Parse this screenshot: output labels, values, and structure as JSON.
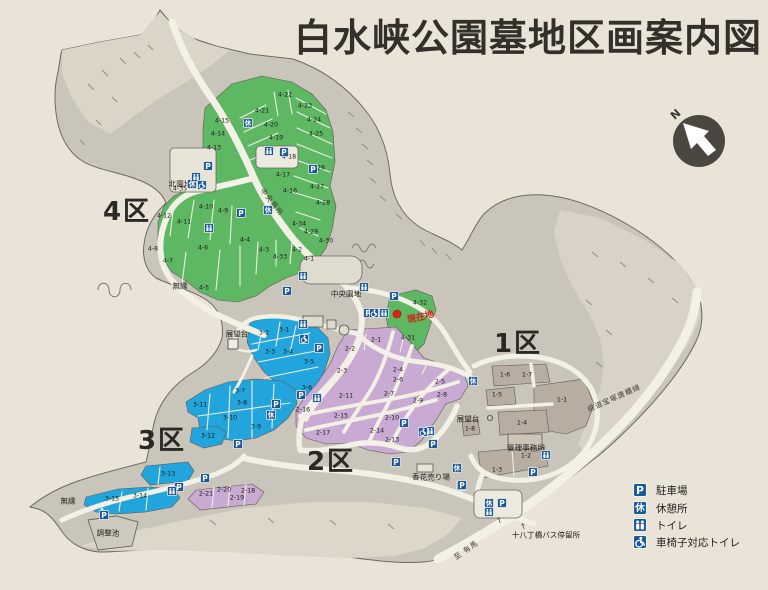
{
  "title": "白水峡公園墓地区画案内図",
  "compass": {
    "label": "N"
  },
  "current_location": {
    "label": "現在地",
    "color": "#d22017"
  },
  "colors": {
    "paper": "#e9e4d7",
    "land": "#cac5ba",
    "light_terrain": "#d9d4c7",
    "road": "#f3f0e5",
    "zone1": "#b7aea1",
    "zone2": "#c8aad3",
    "zone3": "#22a5dc",
    "zone4": "#5eb763",
    "icon_blue": "#1c599c",
    "red": "#e02318"
  },
  "legend": {
    "items": [
      {
        "type": "parking",
        "label": "駐車場"
      },
      {
        "type": "rest",
        "label": "休憩所"
      },
      {
        "type": "toilet",
        "label": "トイレ"
      },
      {
        "type": "wheelchair",
        "label": "車椅子対応トイレ"
      }
    ]
  },
  "zones": [
    {
      "name": "4区",
      "color": "#5eb763",
      "label_x": 127,
      "label_y": 212,
      "plots": [
        {
          "label": "4-1",
          "x": 309,
          "y": 259
        },
        {
          "label": "4-2",
          "x": 297,
          "y": 250
        },
        {
          "label": "4-3",
          "x": 264,
          "y": 250
        },
        {
          "label": "4-4",
          "x": 245,
          "y": 240
        },
        {
          "label": "4-5",
          "x": 204,
          "y": 288
        },
        {
          "label": "4-6",
          "x": 203,
          "y": 248
        },
        {
          "label": "4-7",
          "x": 168,
          "y": 261
        },
        {
          "label": "4-8",
          "x": 153,
          "y": 249
        },
        {
          "label": "4-9",
          "x": 223,
          "y": 211
        },
        {
          "label": "4-10",
          "x": 206,
          "y": 207
        },
        {
          "label": "4-11",
          "x": 184,
          "y": 222
        },
        {
          "label": "4-12",
          "x": 164,
          "y": 216
        },
        {
          "label": "4-13",
          "x": 214,
          "y": 148
        },
        {
          "label": "4-14",
          "x": 218,
          "y": 134
        },
        {
          "label": "4-15",
          "x": 222,
          "y": 121
        },
        {
          "label": "4-16",
          "x": 290,
          "y": 191
        },
        {
          "label": "4-17",
          "x": 283,
          "y": 175
        },
        {
          "label": "4-18",
          "x": 289,
          "y": 157
        },
        {
          "label": "4-19",
          "x": 276,
          "y": 138
        },
        {
          "label": "4-20",
          "x": 271,
          "y": 125
        },
        {
          "label": "4-21",
          "x": 262,
          "y": 111
        },
        {
          "label": "4-22",
          "x": 285,
          "y": 95
        },
        {
          "label": "4-23",
          "x": 305,
          "y": 106
        },
        {
          "label": "4-24",
          "x": 314,
          "y": 120
        },
        {
          "label": "4-25",
          "x": 316,
          "y": 134
        },
        {
          "label": "4-26",
          "x": 318,
          "y": 168
        },
        {
          "label": "4-27",
          "x": 317,
          "y": 187
        },
        {
          "label": "4-28",
          "x": 323,
          "y": 203
        },
        {
          "label": "4-29",
          "x": 311,
          "y": 232
        },
        {
          "label": "4-30",
          "x": 326,
          "y": 241
        },
        {
          "label": "4-31",
          "x": 408,
          "y": 338
        },
        {
          "label": "4-32",
          "x": 420,
          "y": 303
        },
        {
          "label": "4-33",
          "x": 280,
          "y": 257
        },
        {
          "label": "4-34",
          "x": 299,
          "y": 224
        },
        {
          "label": "4-35",
          "x": 180,
          "y": 189
        }
      ]
    },
    {
      "name": "3区",
      "color": "#22a5dc",
      "label_x": 162,
      "label_y": 441,
      "plots": [
        {
          "label": "3-1",
          "x": 284,
          "y": 330
        },
        {
          "label": "3-2",
          "x": 264,
          "y": 333
        },
        {
          "label": "3-3",
          "x": 270,
          "y": 352
        },
        {
          "label": "3-4",
          "x": 288,
          "y": 352
        },
        {
          "label": "3-5",
          "x": 309,
          "y": 362
        },
        {
          "label": "3-6",
          "x": 307,
          "y": 388
        },
        {
          "label": "3-7",
          "x": 240,
          "y": 391
        },
        {
          "label": "3-8",
          "x": 242,
          "y": 403
        },
        {
          "label": "3-9",
          "x": 256,
          "y": 427
        },
        {
          "label": "3-10",
          "x": 230,
          "y": 418
        },
        {
          "label": "3-11",
          "x": 200,
          "y": 405
        },
        {
          "label": "3-12",
          "x": 208,
          "y": 436
        },
        {
          "label": "3-13",
          "x": 168,
          "y": 474
        },
        {
          "label": "3-14",
          "x": 140,
          "y": 496
        },
        {
          "label": "3-15",
          "x": 112,
          "y": 499
        }
      ]
    },
    {
      "name": "2区",
      "color": "#c8aad3",
      "label_x": 331,
      "label_y": 462,
      "plots": [
        {
          "label": "2-1",
          "x": 376,
          "y": 340
        },
        {
          "label": "2-2",
          "x": 350,
          "y": 349
        },
        {
          "label": "2-3",
          "x": 342,
          "y": 371
        },
        {
          "label": "2-4",
          "x": 398,
          "y": 370
        },
        {
          "label": "2-5",
          "x": 440,
          "y": 382
        },
        {
          "label": "2-6",
          "x": 398,
          "y": 380
        },
        {
          "label": "2-7",
          "x": 389,
          "y": 394
        },
        {
          "label": "2-8",
          "x": 442,
          "y": 395
        },
        {
          "label": "2-9",
          "x": 418,
          "y": 401
        },
        {
          "label": "2-10",
          "x": 392,
          "y": 418
        },
        {
          "label": "2-11",
          "x": 346,
          "y": 396
        },
        {
          "label": "2-13",
          "x": 392,
          "y": 440
        },
        {
          "label": "2-14",
          "x": 377,
          "y": 431
        },
        {
          "label": "2-15",
          "x": 341,
          "y": 416
        },
        {
          "label": "2-16",
          "x": 303,
          "y": 410
        },
        {
          "label": "2-17",
          "x": 323,
          "y": 433
        },
        {
          "label": "2-18",
          "x": 248,
          "y": 491
        },
        {
          "label": "2-19",
          "x": 237,
          "y": 498
        },
        {
          "label": "2-20",
          "x": 224,
          "y": 490
        },
        {
          "label": "2-21",
          "x": 206,
          "y": 494
        }
      ]
    },
    {
      "name": "1区",
      "color": "#b7aea1",
      "label_x": 518,
      "label_y": 344,
      "plots": [
        {
          "label": "1-1",
          "x": 562,
          "y": 400
        },
        {
          "label": "1-2",
          "x": 526,
          "y": 456
        },
        {
          "label": "1-3",
          "x": 497,
          "y": 470
        },
        {
          "label": "1-4",
          "x": 522,
          "y": 423
        },
        {
          "label": "1-5",
          "x": 497,
          "y": 395
        },
        {
          "label": "1-6",
          "x": 505,
          "y": 375
        },
        {
          "label": "1-7",
          "x": 527,
          "y": 375
        },
        {
          "label": "1-8",
          "x": 470,
          "y": 429
        }
      ]
    }
  ],
  "places": [
    {
      "label": "北園地",
      "x": 180,
      "y": 184
    },
    {
      "label": "中央園地",
      "x": 346,
      "y": 294
    },
    {
      "label": "展望台",
      "x": 237,
      "y": 334
    },
    {
      "label": "展望台",
      "x": 468,
      "y": 419
    },
    {
      "label": "管理事務所",
      "x": 526,
      "y": 448
    },
    {
      "label": "香花売り場",
      "x": 431,
      "y": 477
    },
    {
      "label": "十八丁橋バス停留所",
      "x": 546,
      "y": 535
    },
    {
      "label": "無縁",
      "x": 180,
      "y": 286
    },
    {
      "label": "無縁",
      "x": 68,
      "y": 501
    },
    {
      "label": "調整池",
      "x": 108,
      "y": 533
    }
  ],
  "road_labels": [
    {
      "label": "中央墓所",
      "x": 272,
      "y": 202,
      "rot": 52
    },
    {
      "label": "県道宝塚唐櫃線",
      "x": 614,
      "y": 398,
      "rot": -24
    },
    {
      "label": "至 有馬",
      "x": 466,
      "y": 550,
      "rot": -35
    }
  ],
  "icons": [
    {
      "type": "parking",
      "x": 208,
      "y": 166
    },
    {
      "type": "parking",
      "x": 284,
      "y": 152
    },
    {
      "type": "parking",
      "x": 313,
      "y": 169
    },
    {
      "type": "parking",
      "x": 241,
      "y": 213
    },
    {
      "type": "parking",
      "x": 287,
      "y": 291
    },
    {
      "type": "parking",
      "x": 394,
      "y": 296
    },
    {
      "type": "parking",
      "x": 368,
      "y": 313
    },
    {
      "type": "parking",
      "x": 319,
      "y": 348
    },
    {
      "type": "parking",
      "x": 301,
      "y": 395
    },
    {
      "type": "parking",
      "x": 276,
      "y": 404
    },
    {
      "type": "parking",
      "x": 238,
      "y": 444
    },
    {
      "type": "parking",
      "x": 404,
      "y": 423
    },
    {
      "type": "parking",
      "x": 433,
      "y": 444
    },
    {
      "type": "parking",
      "x": 396,
      "y": 462
    },
    {
      "type": "parking",
      "x": 461,
      "y": 486
    },
    {
      "type": "parking",
      "x": 205,
      "y": 478
    },
    {
      "type": "parking",
      "x": 179,
      "y": 487
    },
    {
      "type": "parking",
      "x": 104,
      "y": 515
    },
    {
      "type": "parking",
      "x": 533,
      "y": 472
    },
    {
      "type": "parking",
      "x": 462,
      "y": 485
    },
    {
      "type": "parking",
      "x": 502,
      "y": 503
    },
    {
      "type": "rest",
      "x": 248,
      "y": 123
    },
    {
      "type": "rest",
      "x": 268,
      "y": 210
    },
    {
      "type": "rest",
      "x": 192,
      "y": 184
    },
    {
      "type": "rest",
      "x": 271,
      "y": 415
    },
    {
      "type": "rest",
      "x": 473,
      "y": 381
    },
    {
      "type": "rest",
      "x": 457,
      "y": 468
    },
    {
      "type": "rest",
      "x": 489,
      "y": 503
    },
    {
      "type": "toilet",
      "x": 269,
      "y": 151
    },
    {
      "type": "toilet",
      "x": 196,
      "y": 177
    },
    {
      "type": "toilet",
      "x": 209,
      "y": 228
    },
    {
      "type": "toilet",
      "x": 303,
      "y": 276
    },
    {
      "type": "toilet",
      "x": 364,
      "y": 287
    },
    {
      "type": "toilet",
      "x": 384,
      "y": 313
    },
    {
      "type": "toilet",
      "x": 303,
      "y": 324
    },
    {
      "type": "toilet",
      "x": 317,
      "y": 398
    },
    {
      "type": "toilet",
      "x": 430,
      "y": 431
    },
    {
      "type": "toilet",
      "x": 172,
      "y": 491
    },
    {
      "type": "toilet",
      "x": 546,
      "y": 455
    },
    {
      "type": "toilet",
      "x": 489,
      "y": 512
    },
    {
      "type": "wheelchair",
      "x": 202,
      "y": 185
    },
    {
      "type": "wheelchair",
      "x": 304,
      "y": 339
    },
    {
      "type": "wheelchair",
      "x": 374,
      "y": 313
    },
    {
      "type": "wheelchair",
      "x": 423,
      "y": 432
    }
  ]
}
